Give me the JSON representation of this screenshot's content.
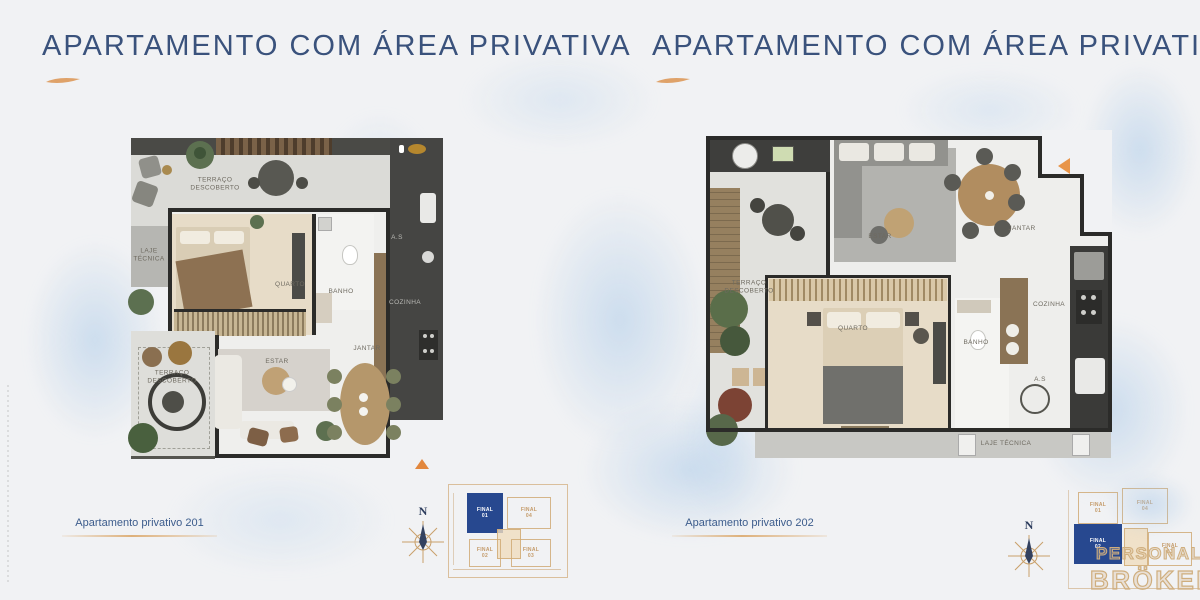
{
  "panels": [
    {
      "title": "APARTAMENTO COM ÁREA PRIVATIVA",
      "caption": "Apartamento privativo 201",
      "compass": "N",
      "rooms": {
        "terraco_top": "TERRAÇO\nDESCOBERTO",
        "laje": "LAJE\nTÉCNICA",
        "quarto": "QUARTO",
        "banho": "BANHO",
        "as": "A.S",
        "cozinha": "COZINHA",
        "estar": "ESTAR",
        "jantar": "JANTAR",
        "terraco_bottom": "TERRAÇO\nDESCOBERTO"
      },
      "keyplan": {
        "final01": "FINAL\n01",
        "final02": "FINAL\n02",
        "final03": "FINAL\n03",
        "final04": "FINAL\n04"
      }
    },
    {
      "title": "APARTAMENTO COM ÁREA PRIVATIVA",
      "caption": "Apartamento privativo 202",
      "compass": "N",
      "rooms": {
        "estar": "ESTAR",
        "jantar": "JANTAR",
        "terraco": "TERRAÇO\nDESCOBERTO",
        "quarto": "QUARTO",
        "banho": "BANHO",
        "as": "A.S",
        "cozinha": "COZINHA",
        "laje": "LAJE TÉCNICA"
      },
      "keyplan": {
        "final01": "FINAL\n01",
        "final02": "FINAL\n02",
        "final03": "FINAL\n03",
        "final04": "FINAL\n04"
      }
    }
  ],
  "logo": {
    "line1": "PERSONAL",
    "line2": "BRÖKER"
  },
  "colors": {
    "title_navy": "#3a527c",
    "accent_orange": "#e2873d",
    "keyplan_tan": "#d0aa76",
    "keyplan_blue": "#27488f",
    "watercolor_blue": "#a8c8e8"
  }
}
